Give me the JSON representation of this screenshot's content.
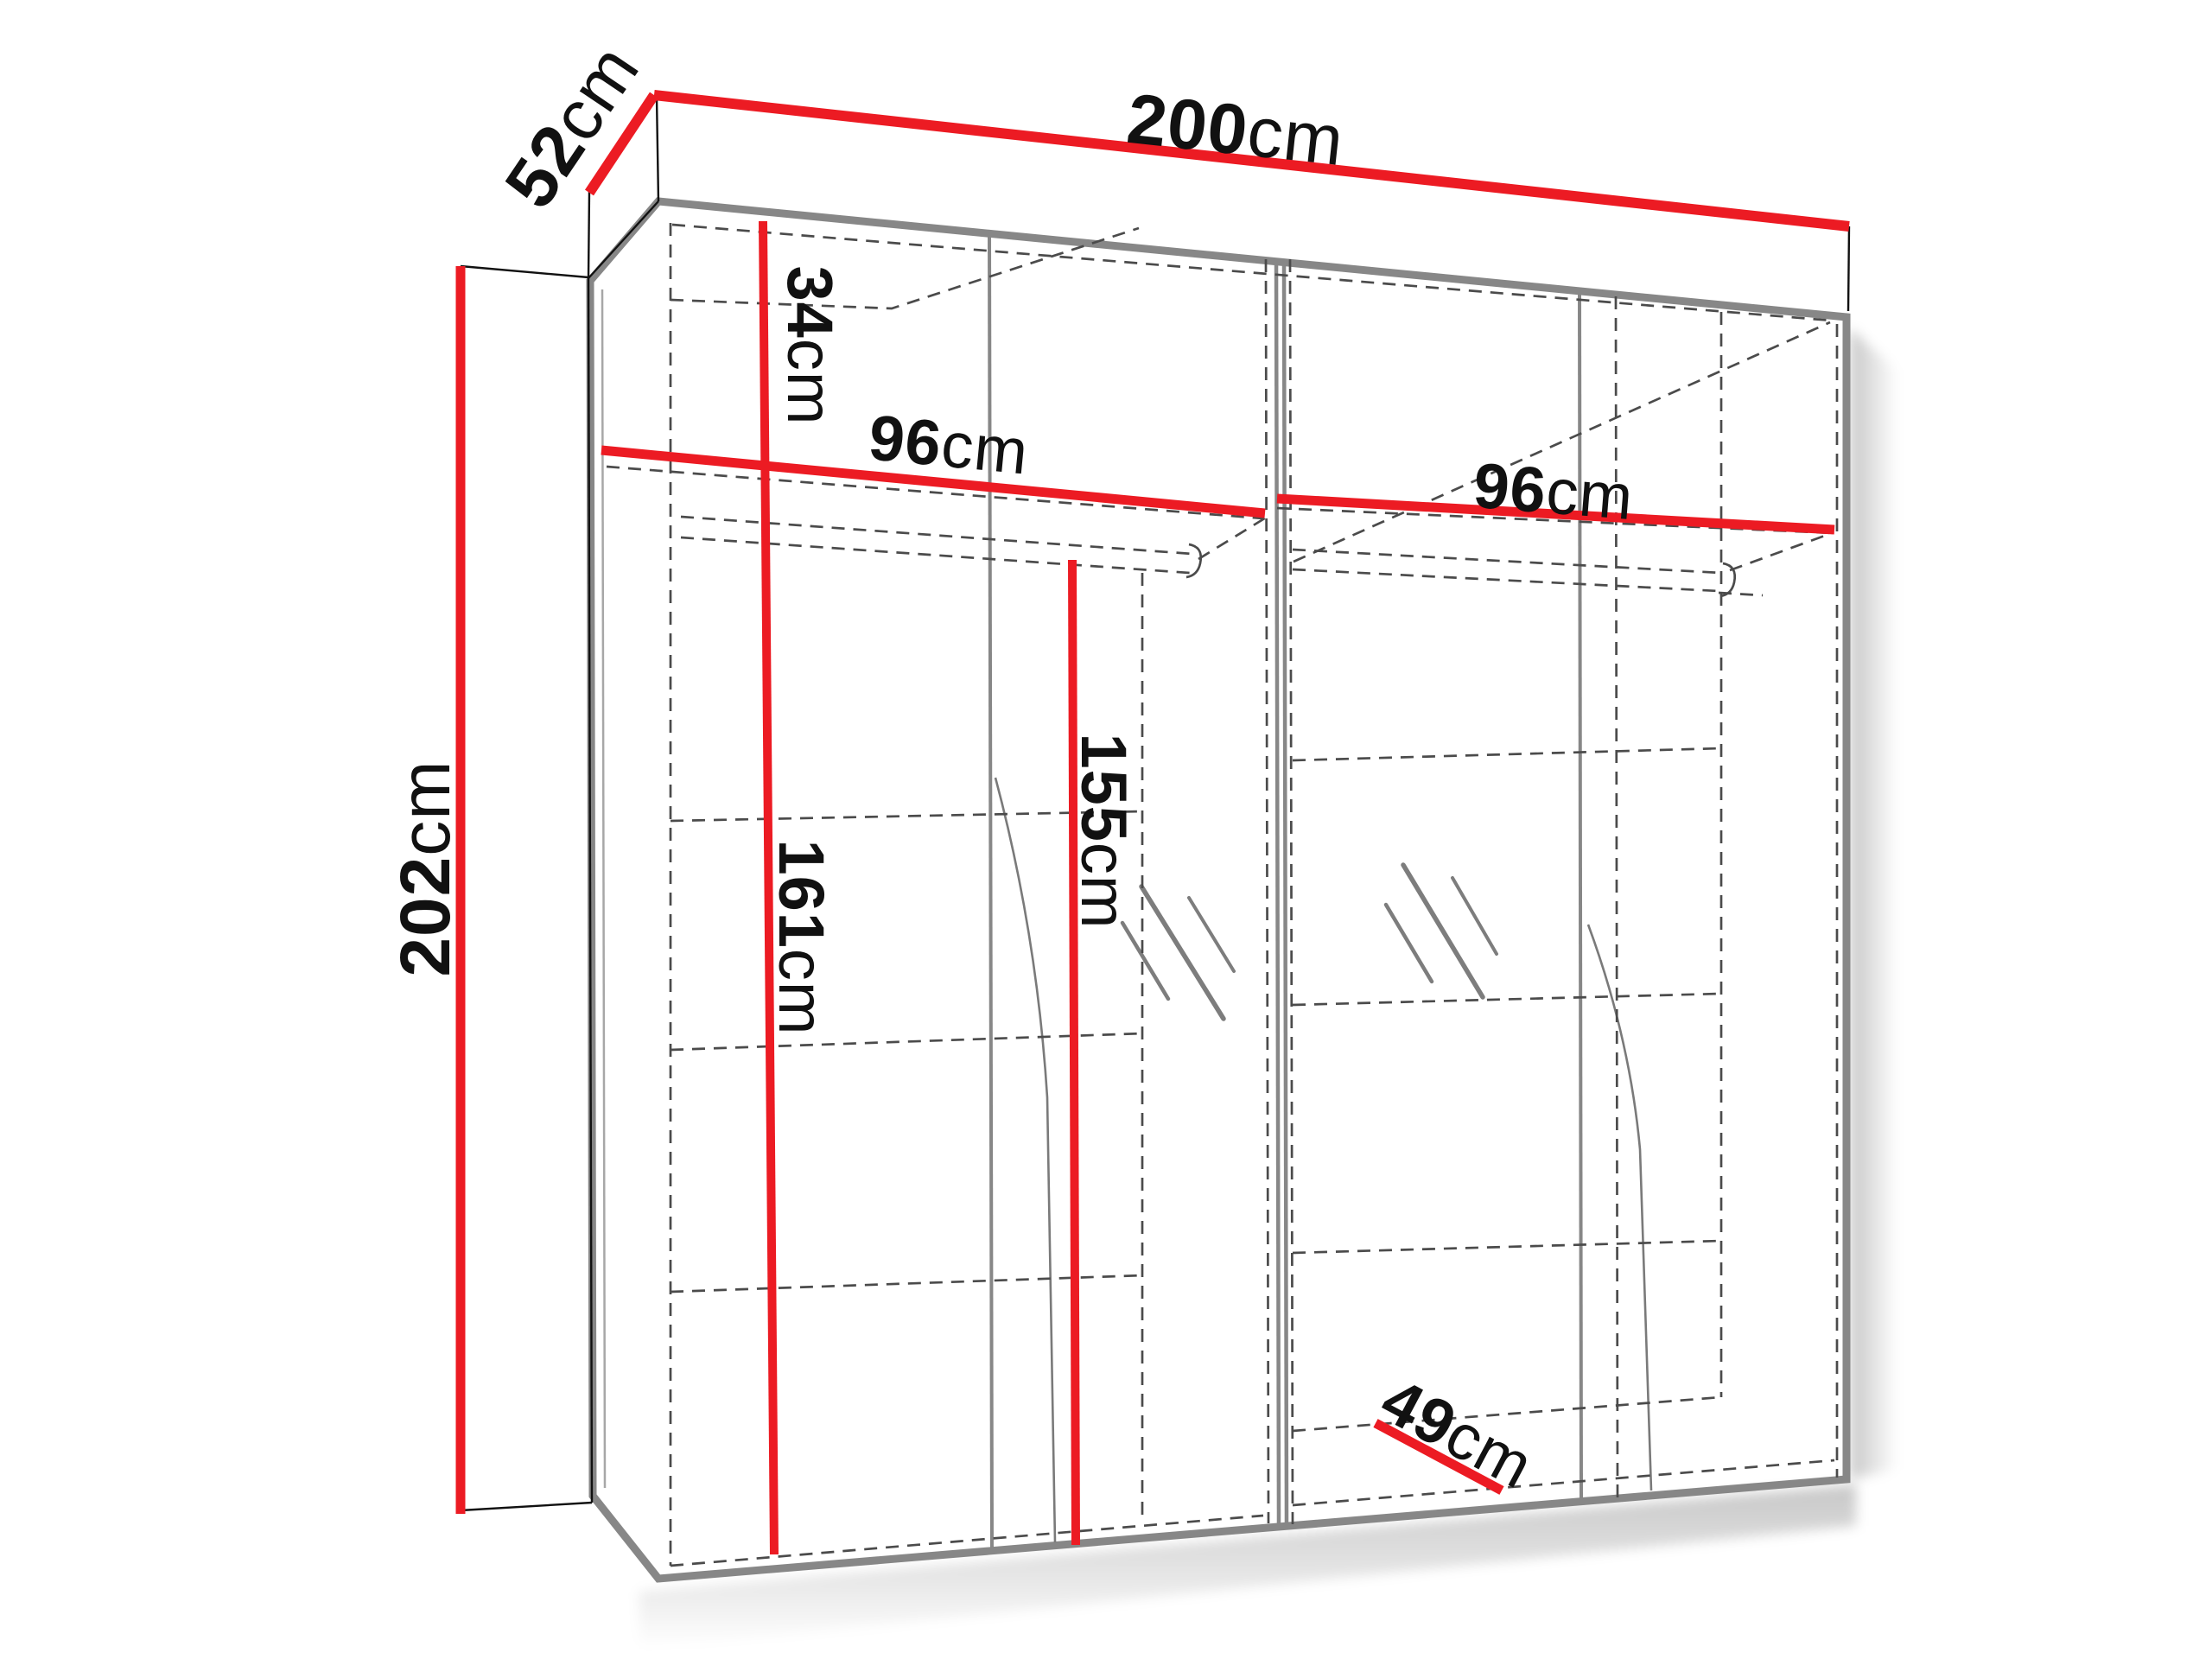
{
  "title": "Wardrobe technical dimensions diagram",
  "diagram_type": "furniture-dimension-drawing",
  "object": "4-door wardrobe with two compartments, shelf and hanging rods",
  "colors": {
    "dimension_line": "#ec1b23",
    "frame": "#878787",
    "hidden_line": "#4b4b4b",
    "text": "#111111",
    "background": "#ffffff"
  },
  "dimensions": {
    "width": {
      "value": "200",
      "unit": "cm"
    },
    "depth": {
      "value": "52",
      "unit": "cm"
    },
    "height": {
      "value": "202",
      "unit": "cm"
    },
    "left_compartment_width": {
      "value": "96",
      "unit": "cm"
    },
    "right_compartment_width": {
      "value": "96",
      "unit": "cm"
    },
    "top_section_height": {
      "value": "34",
      "unit": "cm"
    },
    "lower_section_height": {
      "value": "161",
      "unit": "cm"
    },
    "rod_height": {
      "value": "155",
      "unit": "cm"
    },
    "interior_depth": {
      "value": "49",
      "unit": "cm"
    }
  }
}
